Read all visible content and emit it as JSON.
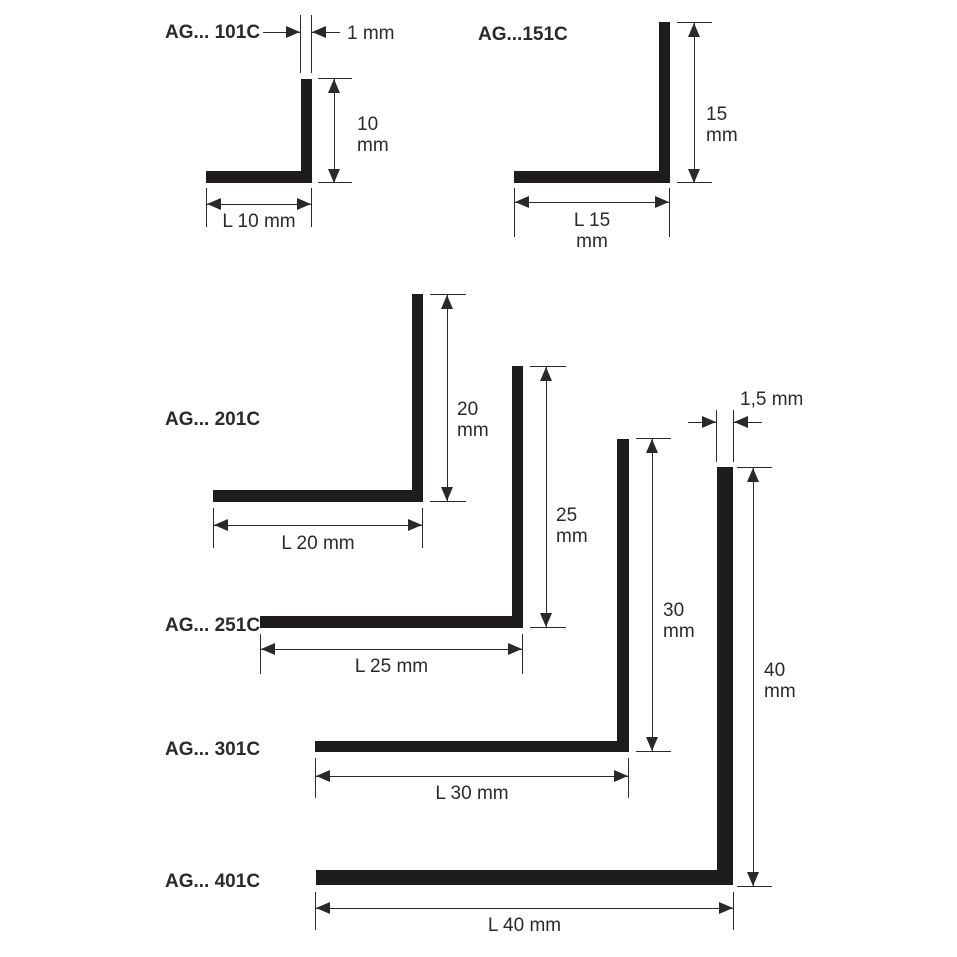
{
  "page": {
    "background_color": "#ffffff",
    "ink_color": "#2b292c",
    "bar_color": "#1e1c1d"
  },
  "profiles": [
    {
      "code": "AG... 101C",
      "thickness_label": "1 mm",
      "height_value": "10",
      "height_unit": "mm",
      "length_line1": "L 10 mm"
    },
    {
      "code": "AG...151C",
      "height_value": "15",
      "height_unit": "mm",
      "length_line1": "L 15",
      "length_line2": "mm"
    },
    {
      "code": "AG... 201C",
      "height_value": "20",
      "height_unit": "mm",
      "length_line1": "L 20 mm"
    },
    {
      "code": "AG... 251C",
      "height_value": "25",
      "height_unit": "mm",
      "length_line1": "L 25 mm"
    },
    {
      "code": "AG... 301C",
      "height_value": "30",
      "height_unit": "mm",
      "length_line1": "L 30 mm"
    },
    {
      "code": "AG... 401C",
      "thickness_label": "1,5 mm",
      "height_value": "40",
      "height_unit": "mm",
      "length_line1": "L 40 mm"
    }
  ]
}
